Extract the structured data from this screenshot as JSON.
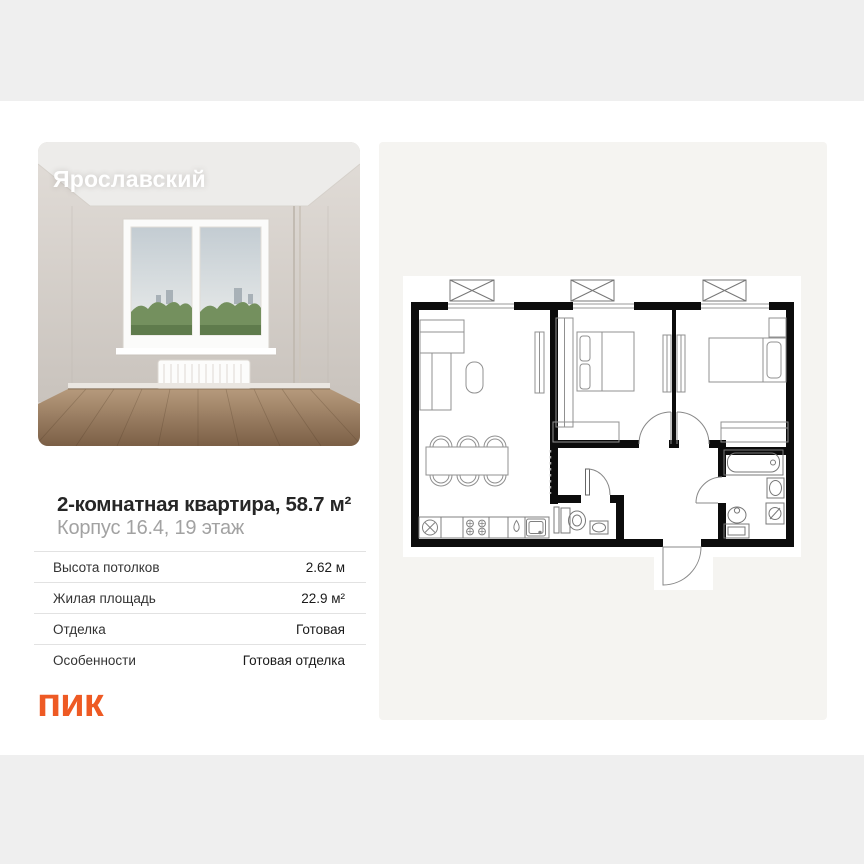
{
  "page": {
    "background": "#ffffff",
    "band_color": "#efefef",
    "panel_color": "#f5f4f1"
  },
  "photo": {
    "label": "Ярославский"
  },
  "listing": {
    "title": "2-комнатная квартира, 58.7 м²",
    "subtitle": "Корпус 16.4, 19 этаж",
    "details": [
      {
        "label": "Высота потолков",
        "value": "2.62 м"
      },
      {
        "label": "Жилая площадь",
        "value": "22.9 м²"
      },
      {
        "label": "Отделка",
        "value": "Готовая"
      },
      {
        "label": "Особенности",
        "value": "Готовая отделка"
      }
    ]
  },
  "floorplan": {
    "wall_color": "#0c0c0c",
    "rooms_note": "2-room plan: living room with kitchen, two bedrooms, WC, bathroom, hall"
  },
  "brand": {
    "logo_text": "пик",
    "color": "#ee5a24"
  }
}
